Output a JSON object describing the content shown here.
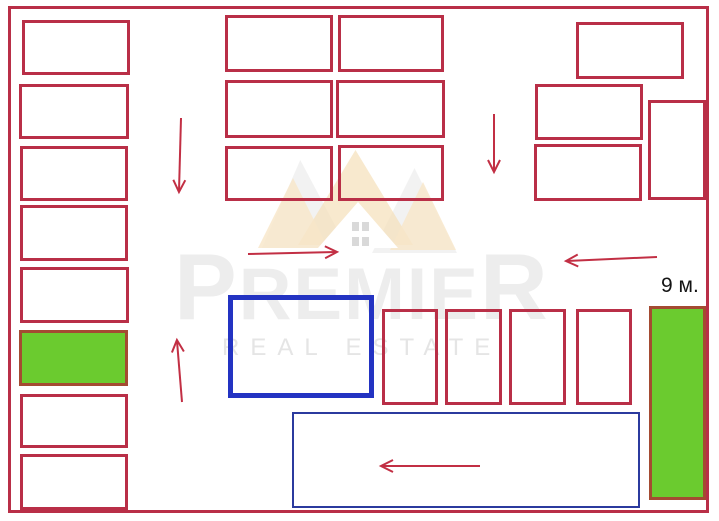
{
  "watermark": {
    "brand_first": "P",
    "brand_mid": "REMIE",
    "brand_last": "R",
    "subtitle": "REAL ESTATE"
  },
  "labels": {
    "green_strip_width": "9 м."
  },
  "colors": {
    "stall_outline": "#b92f47",
    "arrow": "#c22f44",
    "highlight_fill": "#6bcb2f",
    "highlight_border": "#a44b32",
    "zone_blue_thick": "#2333c2",
    "zone_blue_thin": "#2b3a9e",
    "watermark_gray": "#ededed",
    "watermark_crown_orange": "#f5ddb4"
  },
  "diagram": {
    "rects": [
      {
        "name": "unit-rect",
        "x": 22,
        "y": 20,
        "w": 108,
        "h": 55,
        "style": "red"
      },
      {
        "name": "unit-rect",
        "x": 19,
        "y": 84,
        "w": 110,
        "h": 55,
        "style": "red"
      },
      {
        "name": "unit-rect",
        "x": 20,
        "y": 146,
        "w": 108,
        "h": 55,
        "style": "red"
      },
      {
        "name": "unit-rect",
        "x": 20,
        "y": 205,
        "w": 108,
        "h": 56,
        "style": "red"
      },
      {
        "name": "unit-rect",
        "x": 20,
        "y": 267,
        "w": 109,
        "h": 56,
        "style": "red"
      },
      {
        "name": "unit-rect-highlighted",
        "x": 19,
        "y": 330,
        "w": 109,
        "h": 56,
        "style": "green"
      },
      {
        "name": "unit-rect",
        "x": 20,
        "y": 394,
        "w": 108,
        "h": 54,
        "style": "red"
      },
      {
        "name": "unit-rect",
        "x": 20,
        "y": 454,
        "w": 108,
        "h": 56,
        "style": "red"
      },
      {
        "name": "unit-rect",
        "x": 225,
        "y": 15,
        "w": 108,
        "h": 57,
        "style": "red"
      },
      {
        "name": "unit-rect",
        "x": 338,
        "y": 15,
        "w": 106,
        "h": 57,
        "style": "red"
      },
      {
        "name": "unit-rect",
        "x": 225,
        "y": 80,
        "w": 108,
        "h": 58,
        "style": "red"
      },
      {
        "name": "unit-rect",
        "x": 336,
        "y": 80,
        "w": 109,
        "h": 58,
        "style": "red"
      },
      {
        "name": "unit-rect",
        "x": 225,
        "y": 146,
        "w": 108,
        "h": 55,
        "style": "red"
      },
      {
        "name": "unit-rect",
        "x": 338,
        "y": 145,
        "w": 106,
        "h": 56,
        "style": "red"
      },
      {
        "name": "unit-rect",
        "x": 576,
        "y": 22,
        "w": 108,
        "h": 57,
        "style": "red"
      },
      {
        "name": "unit-rect",
        "x": 535,
        "y": 84,
        "w": 108,
        "h": 56,
        "style": "red"
      },
      {
        "name": "unit-rect",
        "x": 534,
        "y": 144,
        "w": 108,
        "h": 57,
        "style": "red"
      },
      {
        "name": "unit-rect",
        "x": 648,
        "y": 100,
        "w": 58,
        "h": 100,
        "style": "red"
      },
      {
        "name": "unit-rect",
        "x": 382,
        "y": 309,
        "w": 56,
        "h": 96,
        "style": "red"
      },
      {
        "name": "unit-rect",
        "x": 445,
        "y": 309,
        "w": 57,
        "h": 96,
        "style": "red"
      },
      {
        "name": "unit-rect",
        "x": 509,
        "y": 309,
        "w": 57,
        "h": 96,
        "style": "red"
      },
      {
        "name": "unit-rect",
        "x": 576,
        "y": 309,
        "w": 56,
        "h": 96,
        "style": "red"
      },
      {
        "name": "zone-outline-blue-thick",
        "x": 228,
        "y": 295,
        "w": 146,
        "h": 103,
        "style": "blue-thick"
      },
      {
        "name": "zone-outline-blue-thin",
        "x": 292,
        "y": 412,
        "w": 348,
        "h": 96,
        "style": "blue-thin"
      },
      {
        "name": "green-strip",
        "x": 649,
        "y": 306,
        "w": 57,
        "h": 194,
        "style": "green"
      }
    ],
    "arrows": [
      {
        "x1": 181,
        "y1": 118,
        "x2": 179,
        "y2": 191
      },
      {
        "x1": 494,
        "y1": 114,
        "x2": 494,
        "y2": 171
      },
      {
        "x1": 248,
        "y1": 254,
        "x2": 336,
        "y2": 252
      },
      {
        "x1": 182,
        "y1": 402,
        "x2": 177,
        "y2": 341
      },
      {
        "x1": 657,
        "y1": 257,
        "x2": 567,
        "y2": 261
      },
      {
        "x1": 480,
        "y1": 466,
        "x2": 382,
        "y2": 466
      }
    ]
  }
}
